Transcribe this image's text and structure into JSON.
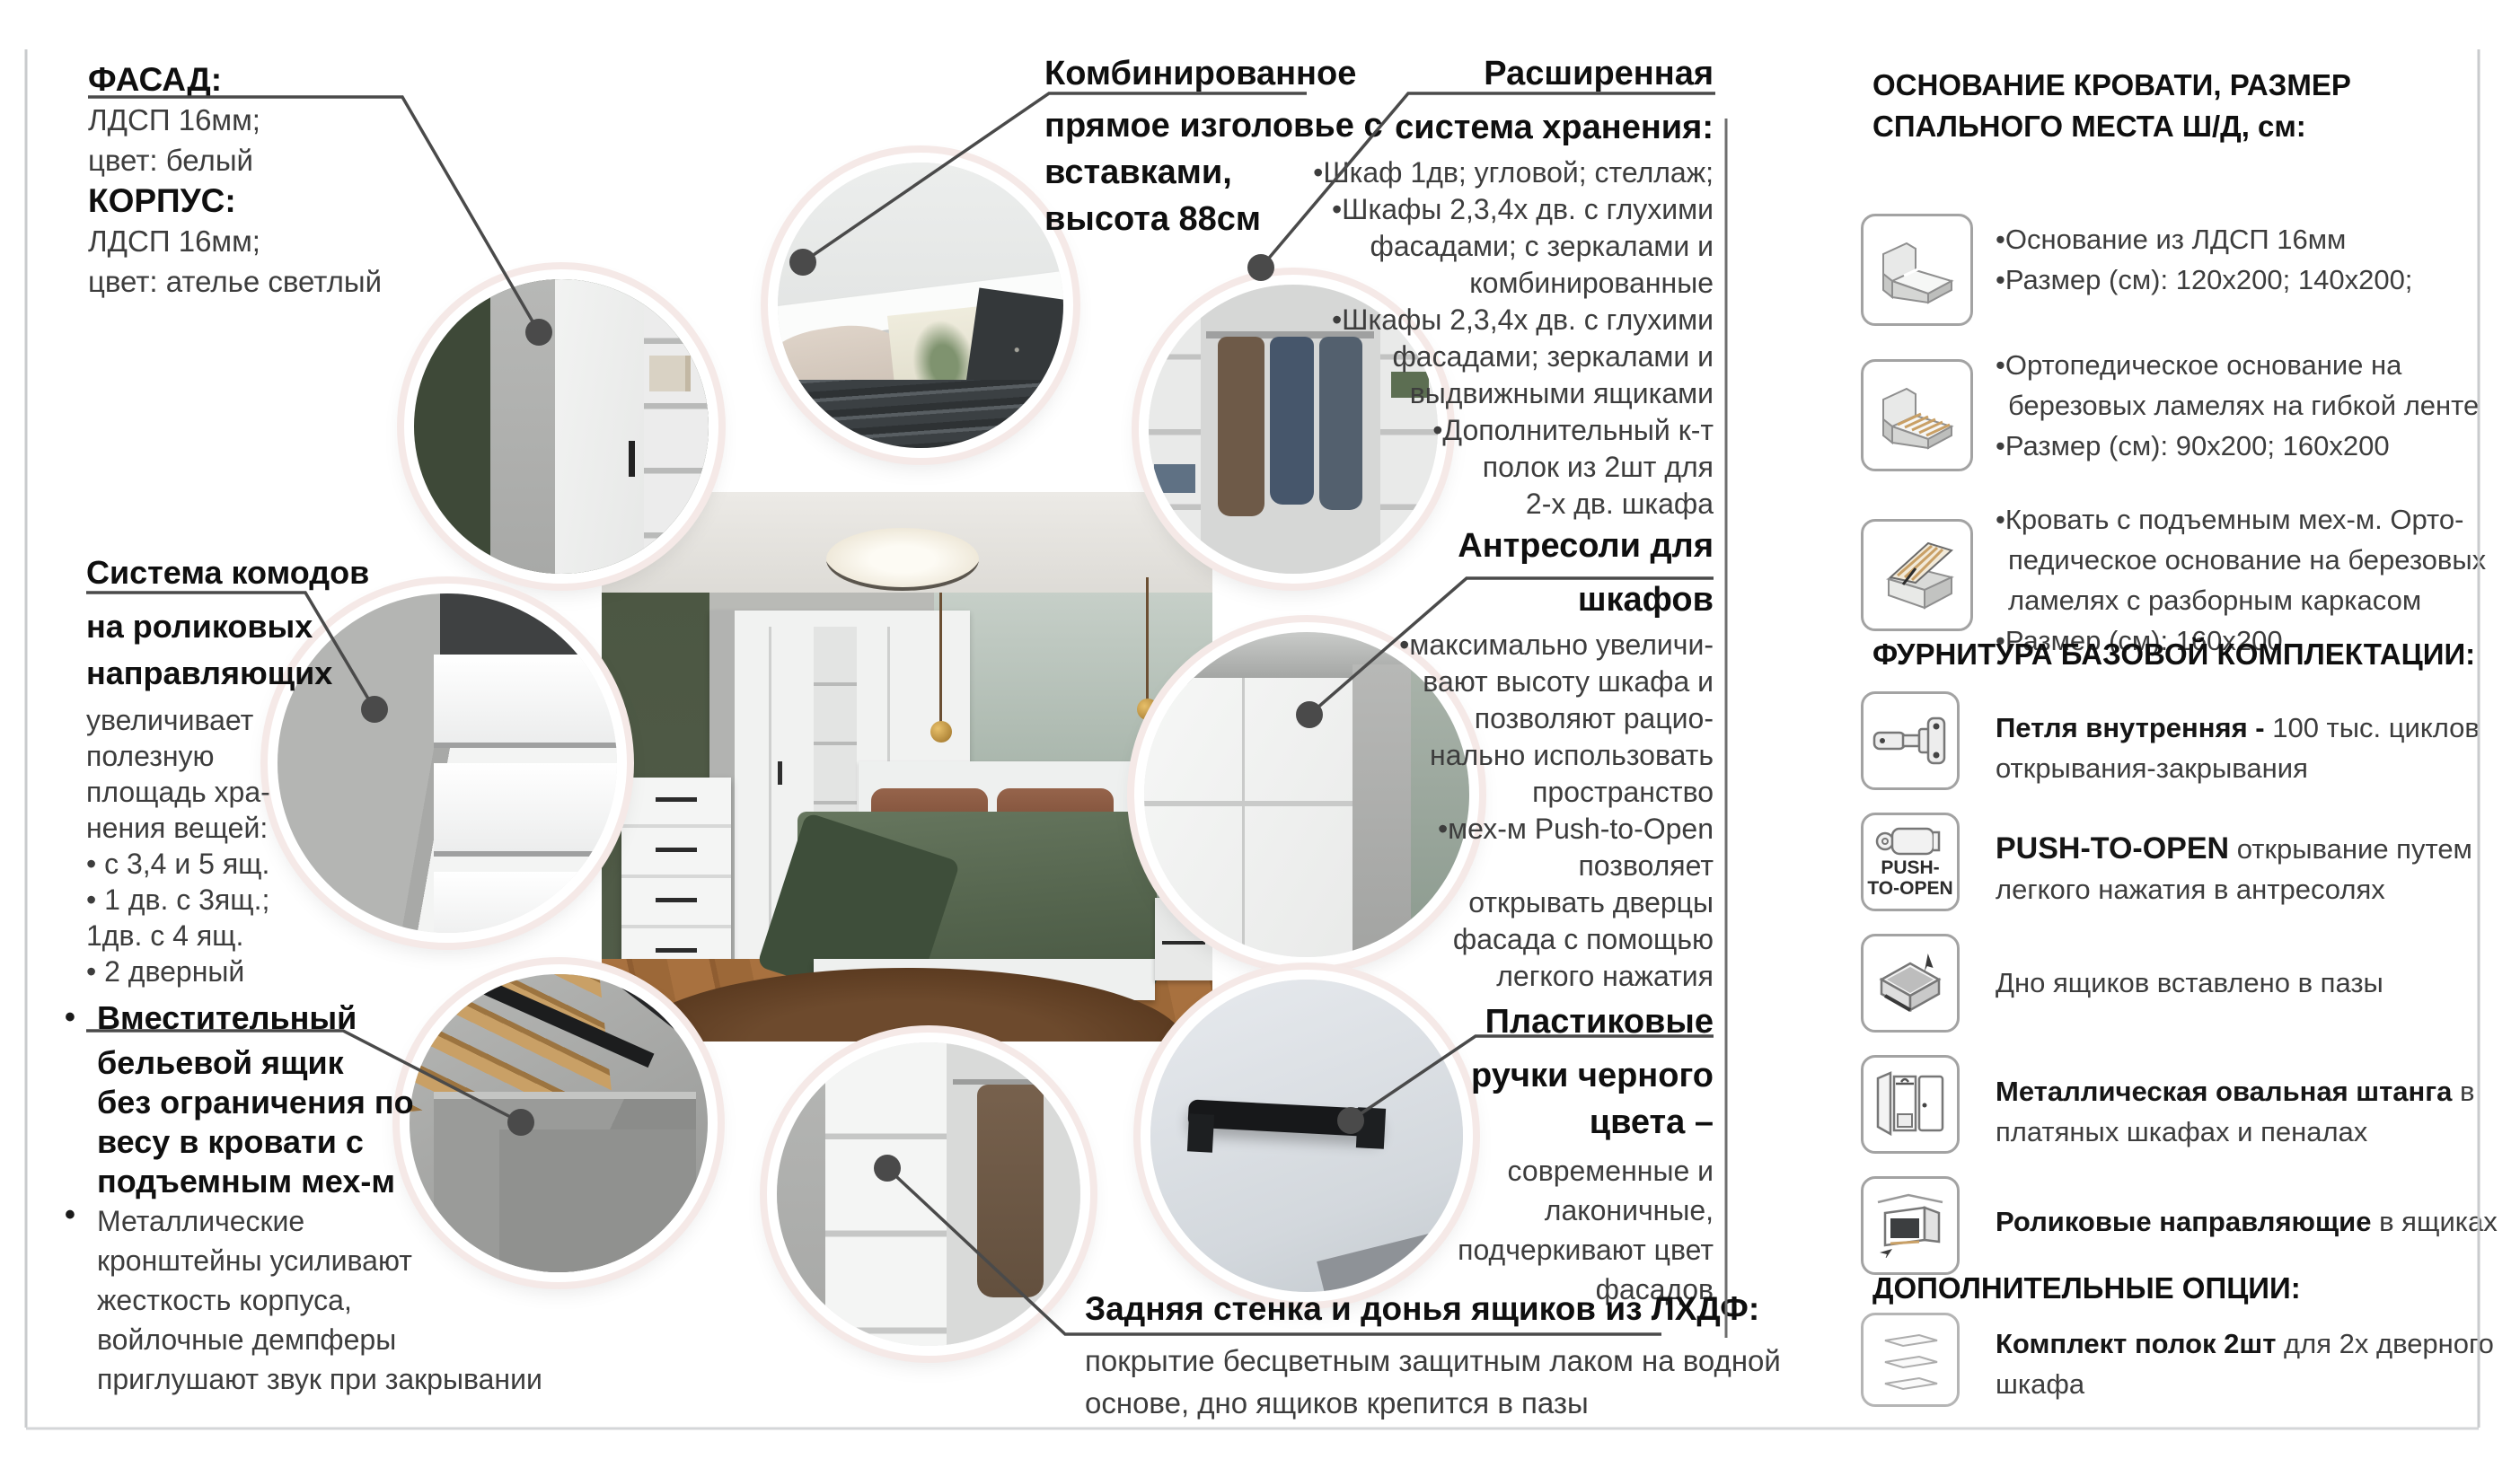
{
  "page": {
    "background": "#ffffff",
    "frame_line_color": "#c9cbcd",
    "divider_color": "#6e6e6e",
    "connector_color": "#4a4a4a",
    "title_color": "#0f0f0f",
    "body_color": "#3d3d3d",
    "circle_ring_color": "#f5e9e7"
  },
  "left": {
    "facade": {
      "title1": "ФАСАД:",
      "line1": "ЛДСП 16мм;",
      "line2": "цвет: белый",
      "title2": "КОРПУС:",
      "line3": "ЛДСП 16мм;",
      "line4": "цвет: ателье светлый"
    },
    "dressers": {
      "t1": "Система комодов",
      "t2": "на роликовых",
      "t3": "направляющих",
      "b1": "увеличивает",
      "b2": "полезную",
      "b3": "площадь хра-",
      "b4": "нения вещей:",
      "b5": "• с 3,4 и 5 ящ.",
      "b6": "• 1 дв. с 3ящ.;",
      "b7": "1дв. с 4 ящ.",
      "b8": "• 2 дверный"
    },
    "linen": {
      "marker1": "•",
      "marker2": "•",
      "t1": "Вместительный",
      "t2": "бельевой ящик",
      "t3": "без ограничения по",
      "t4": "весу в кровати с",
      "t5": "подъемным мех-м",
      "b1": "Металлические",
      "b2": "кронштейны усиливают",
      "b3": "жесткость корпуса,",
      "b4": "войлочные демпферы",
      "b5": "приглушают звук при закрывании"
    }
  },
  "top": {
    "headboard": {
      "t1": "Комбинированное",
      "t2": "прямое изголовье с",
      "t3": "вставками,",
      "t4": "высота 88см"
    },
    "storage": {
      "t1": "Расширенная",
      "t2": "система хранения:",
      "b1": "•Шкаф 1дв; угловой; стеллаж;",
      "b2": "•Шкафы 2,3,4х дв. с глухими",
      "b3": "фасадами; с зеркалами и",
      "b4": "комбинированные",
      "b5": "•Шкафы 2,3,4х дв. с глухими",
      "b6": "фасадами; зеркалами и",
      "b7": "выдвижными ящиками",
      "b8": "•Дополнительный к-т",
      "b9": "полок из 2шт для",
      "b10": "2-х дв. шкафа"
    }
  },
  "middle": {
    "mezzanine": {
      "t1": "Антресоли для",
      "t2": "шкафов",
      "b1": "•максимально увеличи-",
      "b2": "вают высоту шкафа и",
      "b3": "позволяют рацио-",
      "b4": "нально использовать",
      "b5": "пространство",
      "b6": "•мех-м Push-to-Open",
      "b7": "позволяет",
      "b8": "открывать дверцы",
      "b9": "фасада с помощью",
      "b10": "легкого нажатия"
    },
    "handles": {
      "t1": "Пластиковые",
      "t2": "ручки черного",
      "t3": "цвета –",
      "b1": "современные и",
      "b2": "лаконичные,",
      "b3": "подчеркивают цвет",
      "b4": "фасадов"
    }
  },
  "bottom": {
    "backwall": {
      "t": "Задняя стенка и донья ящиков из ЛХДФ:",
      "b1": "покрытие бесцветным защитным лаком на водной",
      "b2": "основе, дно ящиков крепится в пазы"
    }
  },
  "panel": {
    "h1a": "ОСНОВАНИЕ КРОВАТИ, РАЗМЕР",
    "h1b": "СПАЛЬНОГО МЕСТА Ш/Д, см:",
    "base1": {
      "l1": "•Основание из ЛДСП 16мм",
      "l2": "•Размер (см): 120х200; 140х200;"
    },
    "base2": {
      "l1": "•Ортопедическое основание на",
      "l2": "березовых ламелях на гибкой ленте",
      "l3": "•Размер (см): 90х200; 160х200"
    },
    "base3": {
      "l1": "•Кровать с подъемным мех-м. Орто-",
      "l2": "педическое основание на березовых",
      "l3": "ламелях с разборным каркасом",
      "l4": "•Размер (см): 160х200"
    },
    "h2": "ФУРНИТУРА БАЗОВОЙ КОМПЛЕКТАЦИИ:",
    "f1": {
      "b": "Петля внутренняя -",
      "r1": " 100 тыс. циклов",
      "r2": "открывания-закрывания"
    },
    "f2": {
      "b": "PUSH-TO-OPEN",
      "r1": " открывание путем",
      "r2": "легкого нажатия в антресолях",
      "icon_label1": "PUSH-",
      "icon_label2": "TO-OPEN"
    },
    "f3": {
      "r1": "Дно ящиков вставлено в пазы"
    },
    "f4": {
      "b": "Металлическая овальная штанга",
      "r1": " в",
      "r2": "платяных шкафах и пеналах"
    },
    "f5": {
      "b": "Роликовые направляющие",
      "r1": " в ящиках"
    },
    "h3": "ДОПОЛНИТЕЛЬНЫЕ ОПЦИИ:",
    "opt1": {
      "b": "Комплект полок 2шт",
      "r1": " для 2х дверного",
      "r2": "шкафа"
    }
  },
  "icons": [
    "bed-base-icon",
    "bed-slats-icon",
    "bed-lift-icon",
    "hinge-icon",
    "push-to-open-icon",
    "drawer-bottom-icon",
    "wardrobe-rail-icon",
    "roller-guides-icon",
    "shelves-icon"
  ]
}
